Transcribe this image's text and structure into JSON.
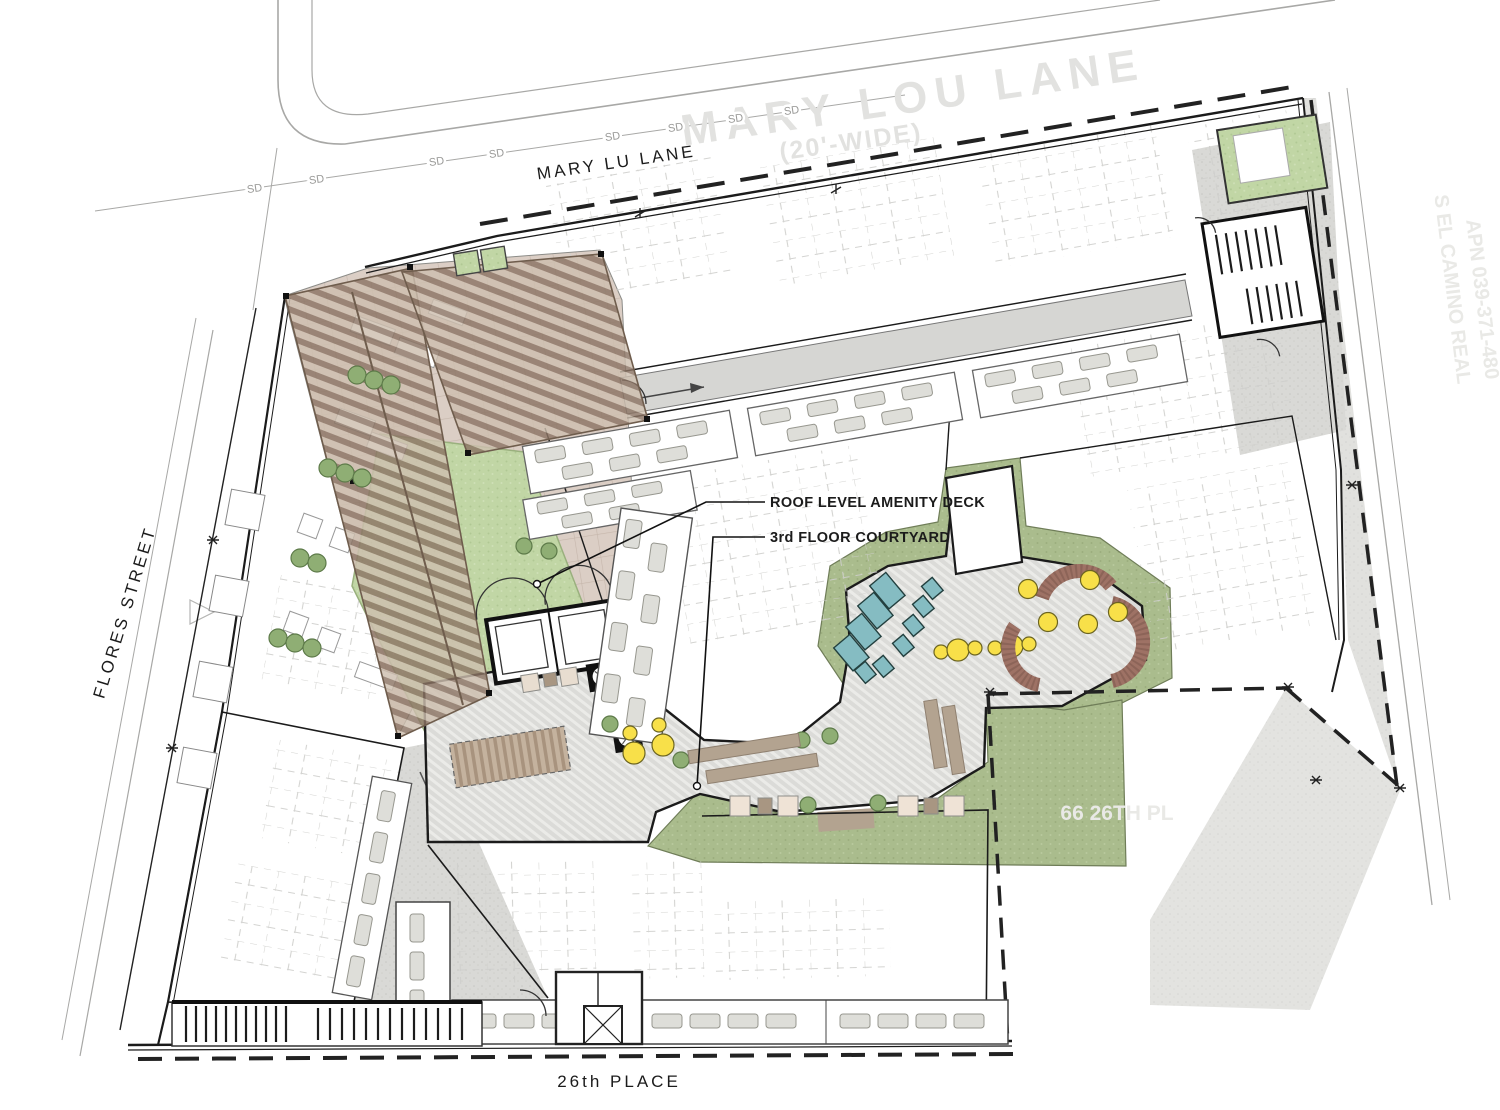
{
  "streets": {
    "mary_lu_lane": "MARY LU LANE",
    "mary_lou_lane_watermark": "MARY LOU LANE",
    "mary_lou_width": "(20'-WIDE)",
    "flores_street": "FLORES STREET",
    "place_26th": "26th PLACE"
  },
  "utilities": {
    "storm_drain_label": "SD"
  },
  "annotations": {
    "roof_deck": "ROOF LEVEL AMENITY DECK",
    "courtyard": "3rd FLOOR COURTYARD"
  },
  "adjacent": {
    "east_street": "S EL CAMINO REAL",
    "east_apn": "APN 039-371-480",
    "south_parcel": "66 26TH PL"
  },
  "colors": {
    "line_dark": "#1b1b1b",
    "street_gray": "#a8a8a6",
    "watermark_gray": "#e2e2e0",
    "paver_tan": "#dbcec5",
    "paver_line": "#c6b6ab",
    "lawn_green": "#c1d6a5",
    "landscape_green": "#aabc8d",
    "deck_gray": "#dbdbd8",
    "trellis_wood": "#8b7464",
    "trellis_light": "#cdbeae",
    "concrete_gray": "#d9d9d6",
    "lounger_teal": "#85bcc2",
    "furniture_yellow": "#f8e049",
    "bench_brown": "#9e7265",
    "bench_tan": "#b3a390",
    "tree_green": "#8fae74",
    "unit_gray": "#deded9"
  }
}
